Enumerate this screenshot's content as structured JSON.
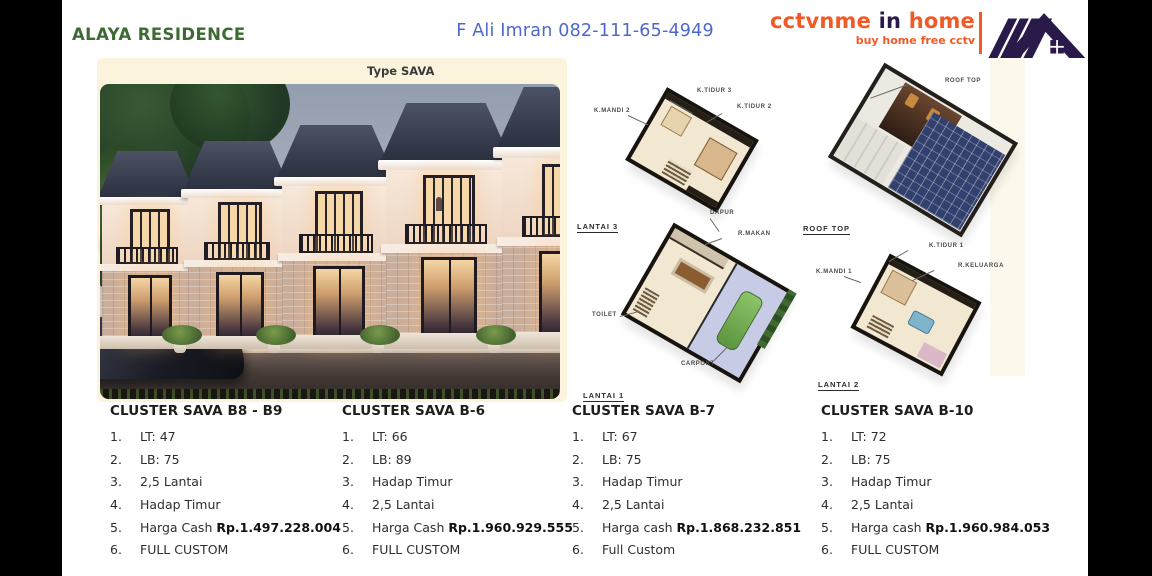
{
  "header": {
    "title": "ALAYA RESIDENCE",
    "contact": "F Ali Imran 082-111-65-4949"
  },
  "logo": {
    "brand": [
      "cctvnme",
      "in",
      "home"
    ],
    "tagline": "buy home free cctv"
  },
  "gallery": {
    "type_label": "Type SAVA",
    "back_icon": "←"
  },
  "floorplan_labels": {
    "k_tidur_3": "K.TIDUR 3",
    "k_mandi_2": "K.MANDI 2",
    "k_tidur_2": "K.TIDUR 2",
    "lantai_3": "LANTAI 3",
    "dapur": "DAPUR",
    "r_makan": "R.MAKAN",
    "toilet": "TOILET",
    "carport": "CARPORT",
    "lantai_1": "LANTAI 1",
    "roof_top_pointer": "ROOF TOP",
    "roof_top": "ROOF TOP",
    "k_tidur_1": "K.TIDUR 1",
    "k_mandi_1": "K.MANDI 1",
    "r_keluarga": "R.KELUARGA",
    "lantai_2": "LANTAI 2"
  },
  "clusters": [
    {
      "title": "CLUSTER SAVA B8 - B9",
      "items": [
        {
          "n": "1.",
          "text": "LT: 47"
        },
        {
          "n": "2.",
          "text": "LB: 75"
        },
        {
          "n": "3.",
          "text": "2,5 Lantai"
        },
        {
          "n": "4.",
          "text": "Hadap Timur"
        },
        {
          "n": "5.",
          "text": "Harga Cash ",
          "price": "Rp.1.497.228.004"
        },
        {
          "n": "6.",
          "text": "FULL CUSTOM"
        }
      ]
    },
    {
      "title": "CLUSTER SAVA B-6",
      "items": [
        {
          "n": "1.",
          "text": "LT: 66"
        },
        {
          "n": "2.",
          "text": "LB: 89"
        },
        {
          "n": "3.",
          "text": "Hadap Timur"
        },
        {
          "n": "4.",
          "text": "2,5 Lantai"
        },
        {
          "n": "5.",
          "text": "Harga Cash ",
          "price": "Rp.1.960.929.555"
        },
        {
          "n": "6.",
          "text": "FULL CUSTOM"
        }
      ]
    },
    {
      "title": "CLUSTER SAVA B-7",
      "items": [
        {
          "n": "1.",
          "text": "LT: 67"
        },
        {
          "n": "2.",
          "text": "LB: 75"
        },
        {
          "n": "3.",
          "text": "Hadap Timur"
        },
        {
          "n": "4.",
          "text": "2,5 Lantai"
        },
        {
          "n": "5.",
          "text": "Harga cash ",
          "price": "Rp.1.868.232.851"
        },
        {
          "n": "6.",
          "text": "Full Custom"
        }
      ]
    },
    {
      "title": "CLUSTER SAVA B-10",
      "items": [
        {
          "n": "1.",
          "text": "LT: 72"
        },
        {
          "n": "2.",
          "text": "LB: 75"
        },
        {
          "n": "3.",
          "text": "Hadap Timur"
        },
        {
          "n": "4.",
          "text": "2,5 Lantai"
        },
        {
          "n": "5.",
          "text": "Harga cash ",
          "price": "Rp.1.960.984.053"
        },
        {
          "n": "6.",
          "text": "FULL CUSTOM"
        }
      ]
    }
  ],
  "colors": {
    "title_green": "#3C6A33",
    "contact_blue": "#4B68CE",
    "brand_orange": "#F15A24",
    "brand_navy": "#2A1A4A",
    "panel_cream": "#FBF3DC"
  }
}
